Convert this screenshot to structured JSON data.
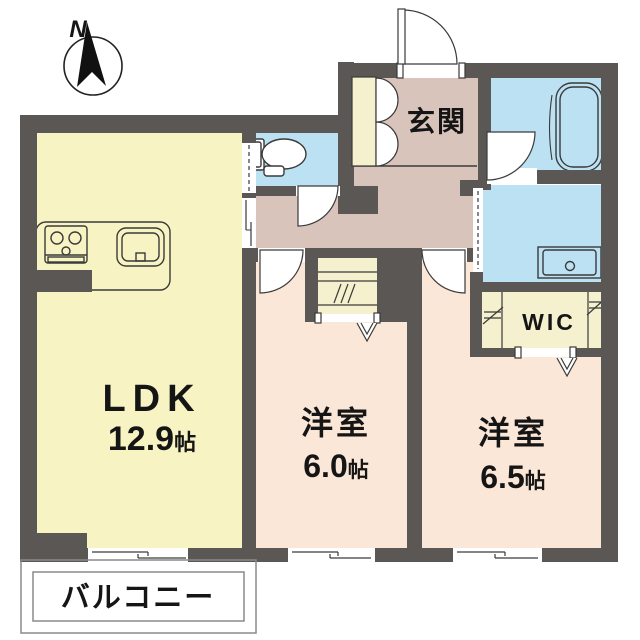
{
  "compass": {
    "label": "N"
  },
  "rooms": {
    "genkan": {
      "label": "玄関"
    },
    "ldk": {
      "label": "LDK",
      "size_value": "12.9",
      "size_unit": "帖"
    },
    "bedroom_center": {
      "label": "洋室",
      "size_value": "6.0",
      "size_unit": "帖"
    },
    "bedroom_right": {
      "label": "洋室",
      "size_value": "6.5",
      "size_unit": "帖"
    },
    "wic": {
      "label": "WIC"
    },
    "balcony": {
      "label": "バルコニー"
    }
  },
  "colors": {
    "wall": "#5a5755",
    "ldk_floor": "#f7f3c3",
    "hall_floor": "#d9c4bc",
    "bedroom_floor": "#fbe7d7",
    "wet_floor": "#bce1f3",
    "closet_floor": "#f5f1ce",
    "line": "#35322f"
  }
}
